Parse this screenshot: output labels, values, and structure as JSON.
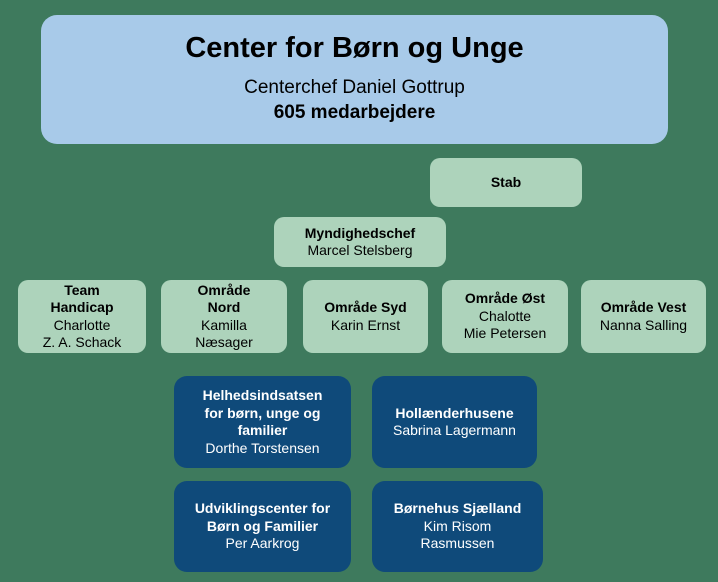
{
  "colors": {
    "background": "#3E7A5D",
    "root_box": "#A8CAE9",
    "department_box": "#ADD3BB",
    "unit_box": "#0F4A7A",
    "text_dark": "#000000",
    "text_light": "#FFFFFF"
  },
  "root": {
    "title": "Center for Børn og Unge",
    "subtitle": "Centerchef Daniel Gottrup",
    "headcount": "605 medarbejdere"
  },
  "stab": {
    "title": "Stab"
  },
  "myndighedschef": {
    "title": "Myndighedschef",
    "name": "Marcel Stelsberg"
  },
  "areas": [
    {
      "title": "Team\nHandicap",
      "name": "Charlotte\nZ. A. Schack"
    },
    {
      "title": "Område\nNord",
      "name": "Kamilla\nNæsager"
    },
    {
      "title": "Område Syd",
      "name": "Karin Ernst"
    },
    {
      "title": "Område Øst",
      "name": "Chalotte\nMie Petersen"
    },
    {
      "title": "Område Vest",
      "name": "Nanna Salling"
    }
  ],
  "units": [
    {
      "title": "Helhedsindsatsen\nfor børn, unge og\nfamilier",
      "name": "Dorthe Torstensen"
    },
    {
      "title": "Hollænderhusene",
      "name": "Sabrina Lagermann"
    },
    {
      "title": "Udviklingscenter for\nBørn og Familier",
      "name": "Per Aarkrog"
    },
    {
      "title": "Børnehus Sjælland",
      "name": "Kim Risom\nRasmussen"
    }
  ]
}
